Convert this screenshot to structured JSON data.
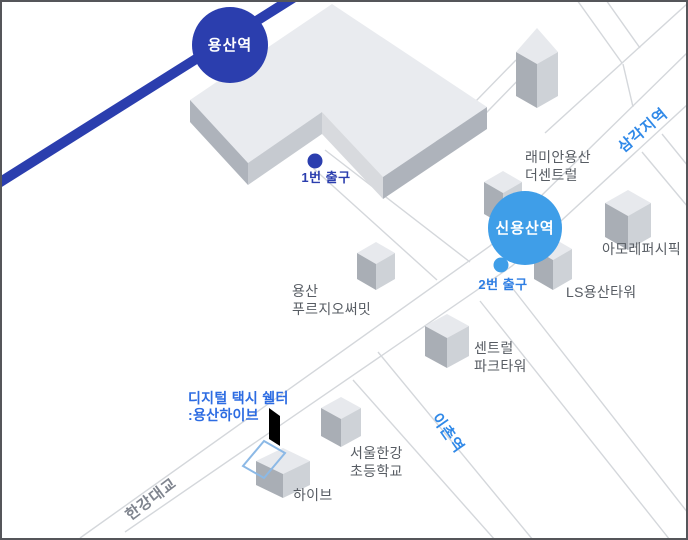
{
  "map": {
    "stations": {
      "yongsan": "용산역",
      "sinyongsan": "신용산역"
    },
    "exits": {
      "exit1": "1번 출구",
      "exit2": "2번 출구"
    },
    "poi": {
      "line1": "디지털 택시 쉘터",
      "line2": ":용산하이브"
    },
    "road_labels": {
      "samgakji": "삼각지역",
      "ichon": "이촌역",
      "hangang_bridge": "한강대교"
    },
    "buildings": {
      "raemian": {
        "line1": "래미안용산",
        "line2": "더센트럴"
      },
      "amore": {
        "line1": "아모레퍼시픽"
      },
      "ls_tower": {
        "line1": "LS용산타워"
      },
      "prugio": {
        "line1": "용산",
        "line2": "푸르지오써밋"
      },
      "central_park": {
        "line1": "센트럴",
        "line2": "파크타워"
      },
      "school": {
        "line1": "서울한강",
        "line2": "초등학교"
      },
      "hybe": {
        "line1": "하이브"
      }
    },
    "colors": {
      "rail_blue": "#2b3eae",
      "station_light_blue": "#3f9ee8",
      "exit2_blue": "#2e7ee3",
      "road_label_blue": "#3089e8",
      "bridge_label_gray": "#7f848e",
      "poi_blue": "#2d6ce2",
      "road_line_gray": "#d4d7db",
      "building_top": "#e7e9ed",
      "building_left": "#a9aeb5",
      "building_right": "#ced2d7",
      "shelter_outline_blue": "#8cb9e6",
      "marker_black": "#000000"
    }
  }
}
